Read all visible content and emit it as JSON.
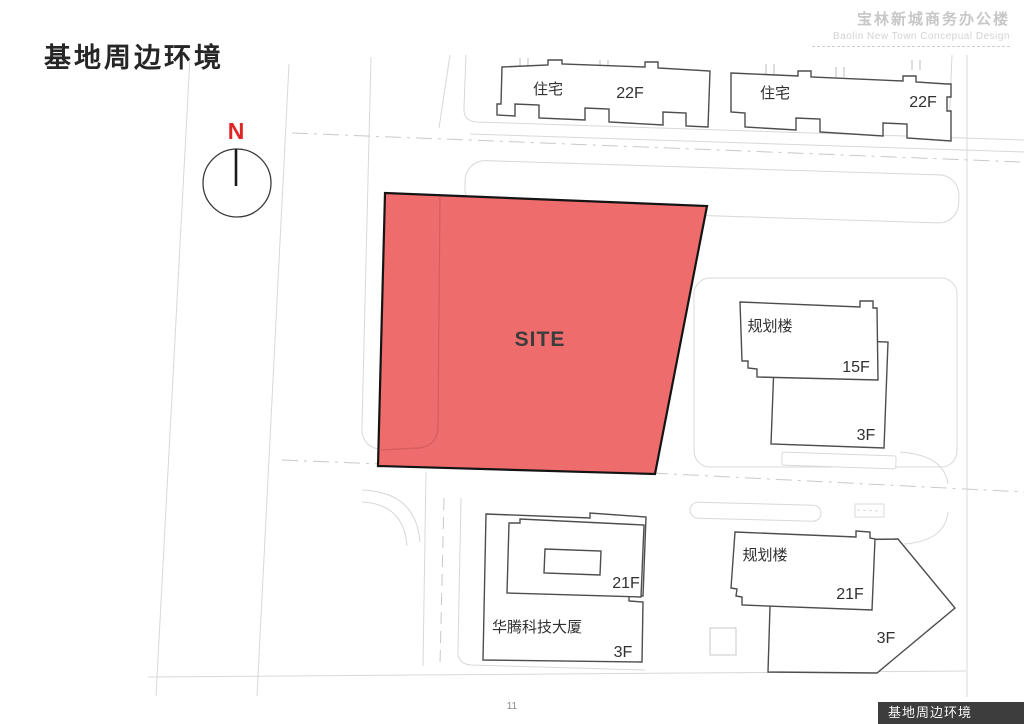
{
  "header": {
    "title_cn": "宝林新城商务办公楼",
    "title_en": "Baolin New Town Concepual Design"
  },
  "page": {
    "title": "基地周边环境",
    "number": "11",
    "footer_tab": "基地周边环境"
  },
  "map": {
    "site_label": "SITE",
    "compass_label": "N",
    "labels": {
      "res1_name": "住宅",
      "res1_floors": "22F",
      "res2_name": "住宅",
      "res2_floors": "22F",
      "planned_e_name": "规划楼",
      "planned_e_floors": "15F",
      "planned_e_podium": "3F",
      "huateng_name": "华腾科技大厦",
      "huateng_floors": "21F",
      "huateng_podium": "3F",
      "planned_s_name": "规划楼",
      "planned_s_floors": "21F",
      "planned_s_podium": "3F"
    },
    "colors": {
      "site_fill": "#ee6c6c",
      "site_stroke": "#141414",
      "building_stroke": "#4d4d4d",
      "road_gray": "#d8d8d8",
      "compass_red": "#e02525",
      "footer_bg": "#3d3d3d"
    }
  }
}
